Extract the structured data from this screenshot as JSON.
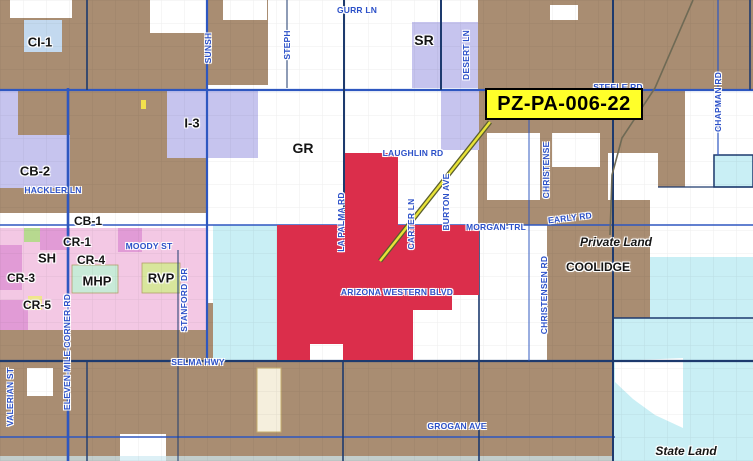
{
  "map": {
    "callout": {
      "label": "PZ-PA-006-22"
    },
    "colors": {
      "brown": "#a98d72",
      "red": "#db2e4b",
      "lavender": "#c6c4ee",
      "light_blue": "#c3d9ef",
      "pink": "#f3c8e4",
      "magenta": "#e19bd6",
      "teal": "#c8ead8",
      "yellow_green": "#d8e69c",
      "cyan": "#c9eff5",
      "cream": "#f5efdd",
      "street_blue": "#2b50c8",
      "road_line": "#2e57c0",
      "section_line": "#1d3a6e",
      "callout_fill": "#ffff2a",
      "callout_border": "#000000",
      "leader_yellow": "#e8e337",
      "leader_outline": "#5a5e2e",
      "railroad": "#6f6a55"
    },
    "zone_labels": [
      {
        "label": "CI-1",
        "x": 40,
        "y": 42,
        "fs": 13
      },
      {
        "label": "SR",
        "x": 424,
        "y": 40,
        "fs": 14
      },
      {
        "label": "I-3",
        "x": 192,
        "y": 123,
        "fs": 13
      },
      {
        "label": "GR",
        "x": 303,
        "y": 148,
        "fs": 14
      },
      {
        "label": "CB-2",
        "x": 35,
        "y": 171,
        "fs": 13
      },
      {
        "label": "CB-1",
        "x": 88,
        "y": 221,
        "fs": 12
      },
      {
        "label": "CR-1",
        "x": 77,
        "y": 242,
        "fs": 12
      },
      {
        "label": "SH",
        "x": 47,
        "y": 258,
        "fs": 13
      },
      {
        "label": "CR-4",
        "x": 91,
        "y": 260,
        "fs": 12
      },
      {
        "label": "CR-3",
        "x": 21,
        "y": 278,
        "fs": 12
      },
      {
        "label": "MHP",
        "x": 97,
        "y": 281,
        "fs": 13
      },
      {
        "label": "RVP",
        "x": 161,
        "y": 278,
        "fs": 13
      },
      {
        "label": "CR-5",
        "x": 37,
        "y": 305,
        "fs": 12
      }
    ],
    "area_labels": [
      {
        "label": "Private Land",
        "x": 616,
        "y": 242,
        "fs": 12,
        "style": "italic"
      },
      {
        "label": "COOLIDGE",
        "x": 598,
        "y": 267,
        "fs": 12,
        "style": "normal"
      },
      {
        "label": "State Land",
        "x": 686,
        "y": 451,
        "fs": 12,
        "style": "italic"
      }
    ],
    "streets_horizontal": [
      {
        "label": "GURR LN",
        "x": 357,
        "y": 10
      },
      {
        "label": "STEELE RD",
        "x": 618,
        "y": 87
      },
      {
        "label": "LAUGHLIN RD",
        "x": 413,
        "y": 153
      },
      {
        "label": "HACKLER LN",
        "x": 53,
        "y": 190
      },
      {
        "label": "MOODY ST",
        "x": 149,
        "y": 246
      },
      {
        "label": "EARLY RD",
        "x": 570,
        "y": 218,
        "rot": -7
      },
      {
        "label": "MORGAN-TRL",
        "x": 496,
        "y": 227
      },
      {
        "label": "ARIZONA WESTERN BLVD",
        "x": 397,
        "y": 292
      },
      {
        "label": "SELMA HWY",
        "x": 198,
        "y": 362
      },
      {
        "label": "GROGAN AVE",
        "x": 457,
        "y": 426
      }
    ],
    "streets_vertical": [
      {
        "label": "SUNSH",
        "x": 208,
        "y": 48
      },
      {
        "label": "STEPH",
        "x": 287,
        "y": 45
      },
      {
        "label": "DESERT LN",
        "x": 466,
        "y": 55
      },
      {
        "label": "CHAPMAN RD",
        "x": 718,
        "y": 102
      },
      {
        "label": "CHRISTENSE",
        "x": 546,
        "y": 170
      },
      {
        "label": "BURTON AVE",
        "x": 446,
        "y": 202
      },
      {
        "label": "LA PALMA RD",
        "x": 341,
        "y": 222
      },
      {
        "label": "CARTER LN",
        "x": 411,
        "y": 224
      },
      {
        "label": "CHRISTENSEN RD",
        "x": 544,
        "y": 295
      },
      {
        "label": "STANFORD DR",
        "x": 184,
        "y": 300
      },
      {
        "label": "ELEVEN-MILE-CORNER-RD",
        "x": 67,
        "y": 352
      },
      {
        "label": "VALERIAN ST",
        "x": 10,
        "y": 397
      }
    ]
  }
}
